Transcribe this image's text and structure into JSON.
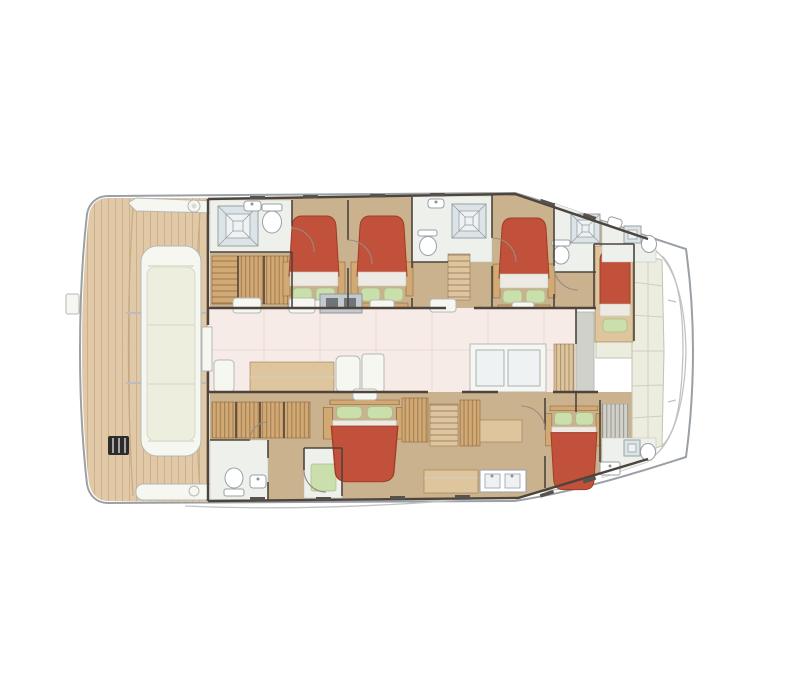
{
  "meta": {
    "description": "Top-down interior layout floor plan of a sailing catamaran",
    "orientation": {
      "bow": "right",
      "stern": "left"
    }
  },
  "palette": {
    "hull_white": "#ffffff",
    "outline": "#9aa0a5",
    "wall": "#4d443c",
    "teak": "#e1c8a7",
    "deck_white": "#f7f7f2",
    "cushion": "#edeedd",
    "floor_tan": "#cbb28e",
    "salon_floor": "#f6ebe6",
    "wood": "#d2a873",
    "wood_light": "#dfc59e",
    "bed_red": "#c1513a",
    "sheet": "#eceae2",
    "pillow": "#cbdfad",
    "bath_floor": "#eef0ec",
    "shower": "#dde4e7",
    "ivory": "#ededdf",
    "grey_panel": "#cfd1ca",
    "steps_grey": "#b4b6b2",
    "ladder_black": "#2e2c2a"
  },
  "inventory": {
    "double_beds": 5,
    "single_berths": 1,
    "toilets": 6,
    "showers": 6,
    "sinks": 6,
    "salon_areas": 1,
    "aft_deck_lounges": 1,
    "stairways": 2
  }
}
